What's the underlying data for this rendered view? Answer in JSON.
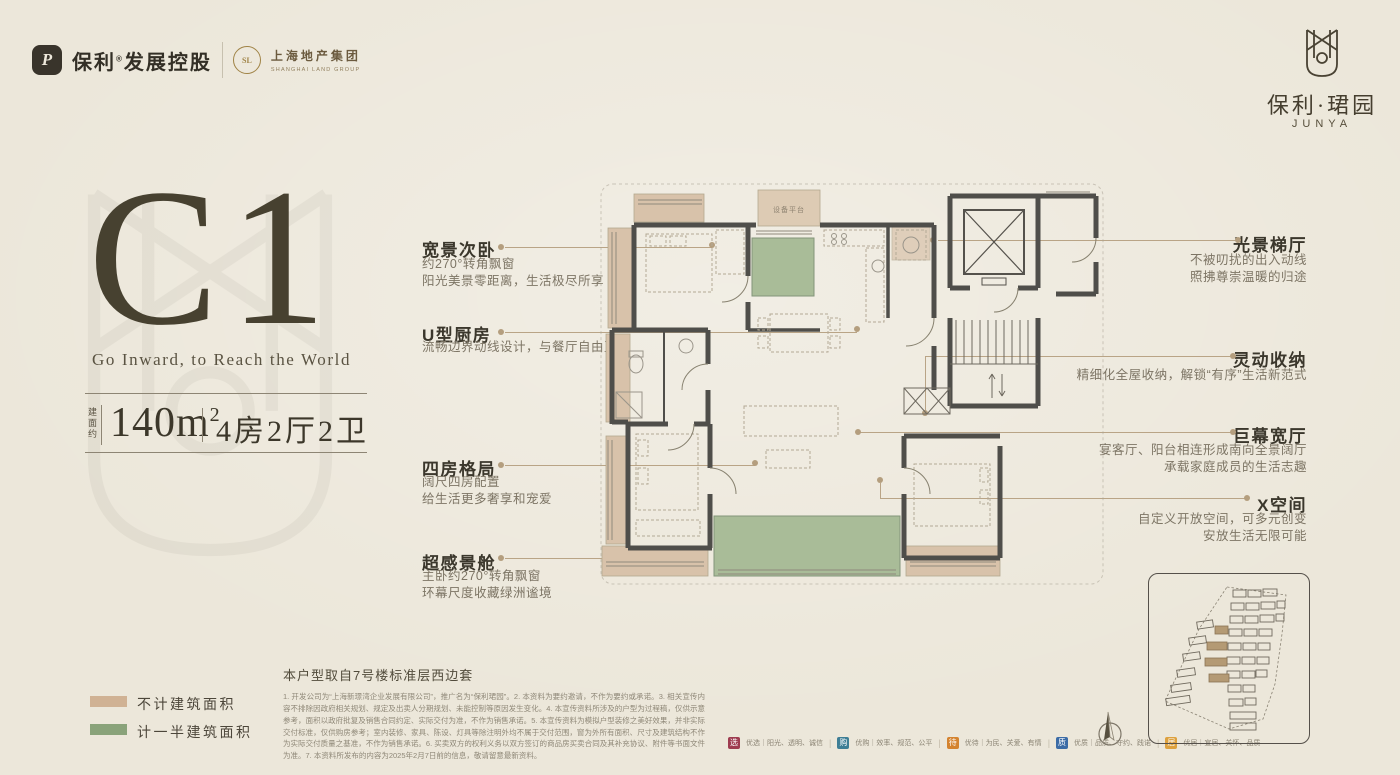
{
  "colors": {
    "paper": "#ece7da",
    "ink": "#3b372c",
    "muted": "#7d7565",
    "gold": "#a08346",
    "leader": "#b9a486",
    "wall": "#4f4e4a",
    "tan_area": "#d8c2aa",
    "green_area": "#a9bc98"
  },
  "header": {
    "brand_left": {
      "part1": "保利",
      "reg": "®",
      "part2": "发展控股",
      "logo_char": "P"
    },
    "partner": {
      "cn": "上海地产集团",
      "en": "SHANGHAI LAND GROUP",
      "ring_char": "SL"
    },
    "brand_right": {
      "cn": "保利·珺园",
      "en": "JUNYA"
    }
  },
  "hero": {
    "unit": "C1",
    "tagline": "Go Inward, to Reach the World",
    "area_label": "建面约",
    "area_value": "140m",
    "area_sup": "2",
    "layout": "4房2厅2卫"
  },
  "features_left": [
    {
      "title": "宽景次卧",
      "lines": [
        "约270°转角飘窗",
        "阳光美景零距离，生活极尽所享"
      ]
    },
    {
      "title": "U型厨房",
      "lines": [
        "流畅边界动线设计，与餐厅自由互动"
      ]
    },
    {
      "title": "四房格局",
      "lines": [
        "阔尺四房配置",
        "给生活更多奢享和宠爱"
      ]
    },
    {
      "title": "超感景舱",
      "lines": [
        "主卧约270°转角飘窗",
        "环幕尺度收藏绿洲谧境"
      ]
    }
  ],
  "features_right": [
    {
      "title": "光景梯厅",
      "lines": [
        "不被叨扰的出入动线",
        "照拂尊崇温暖的归途"
      ]
    },
    {
      "title": "灵动收纳",
      "lines": [
        "精细化全屋收纳，解锁“有序”生活新范式"
      ]
    },
    {
      "title": "巨幕宽厅",
      "lines": [
        "宴客厅、阳台相连形成南向全景阔厅",
        "承载家庭成员的生活志趣"
      ]
    },
    {
      "title": "X空间",
      "lines": [
        "自定义开放空间，可多元创变",
        "安放生活无限可能"
      ]
    }
  ],
  "plan": {
    "platform_label": "设备平台",
    "source_note": "本户型取自7号楼标准层西边套"
  },
  "legend": [
    {
      "label": "不计建筑面积",
      "color": "#d0b294"
    },
    {
      "label": "计一半建筑面积",
      "color": "#8aa37a"
    }
  ],
  "disclaimer": {
    "text": "1. 开发公司为“上海新璟湾企业发展有限公司”，推广名为“保利珺园”。2. 本资料为要约邀请，不作为要约或承诺。3. 相关宣传内容不排除因政府相关规划、规定及出卖人分期规划、未能控制等原因发生变化。4. 本宣传资料所涉及的户型为过程稿，仅供示意参考，面积以政府批复及销售合同约定、实际交付为准，不作为销售承诺。5. 本宣传资料为模拟户型装修之美好效果，并非实际交付标准，仅供购房参考；室内装修、家具、陈设、灯具等除注明外均不属于交付范围，窗为外所有面积、尺寸及建筑结构不作为实际交付质量之基准，不作为销售承诺。6. 买卖双方的权利义务以双方签订的商品房买卖合同及其补充协议、附件等书面文件为准。7. 本资料所发布的内容为2025年2月7日前的信息，敬请留意最新资料。"
  },
  "badges": [
    {
      "char": "选",
      "label": "优选｜阳光、透明、诚信",
      "color": "#9e3c50"
    },
    {
      "char": "购",
      "label": "优购｜效率、规范、公平",
      "color": "#3e7e95"
    },
    {
      "char": "待",
      "label": "优待｜为民、关爱、有情",
      "color": "#d4832f"
    },
    {
      "char": "质",
      "label": "优质｜品质、守约、践诺",
      "color": "#3c6ca6"
    },
    {
      "char": "居",
      "label": "优居｜宜居、关怀、品质",
      "color": "#dda13e"
    }
  ]
}
